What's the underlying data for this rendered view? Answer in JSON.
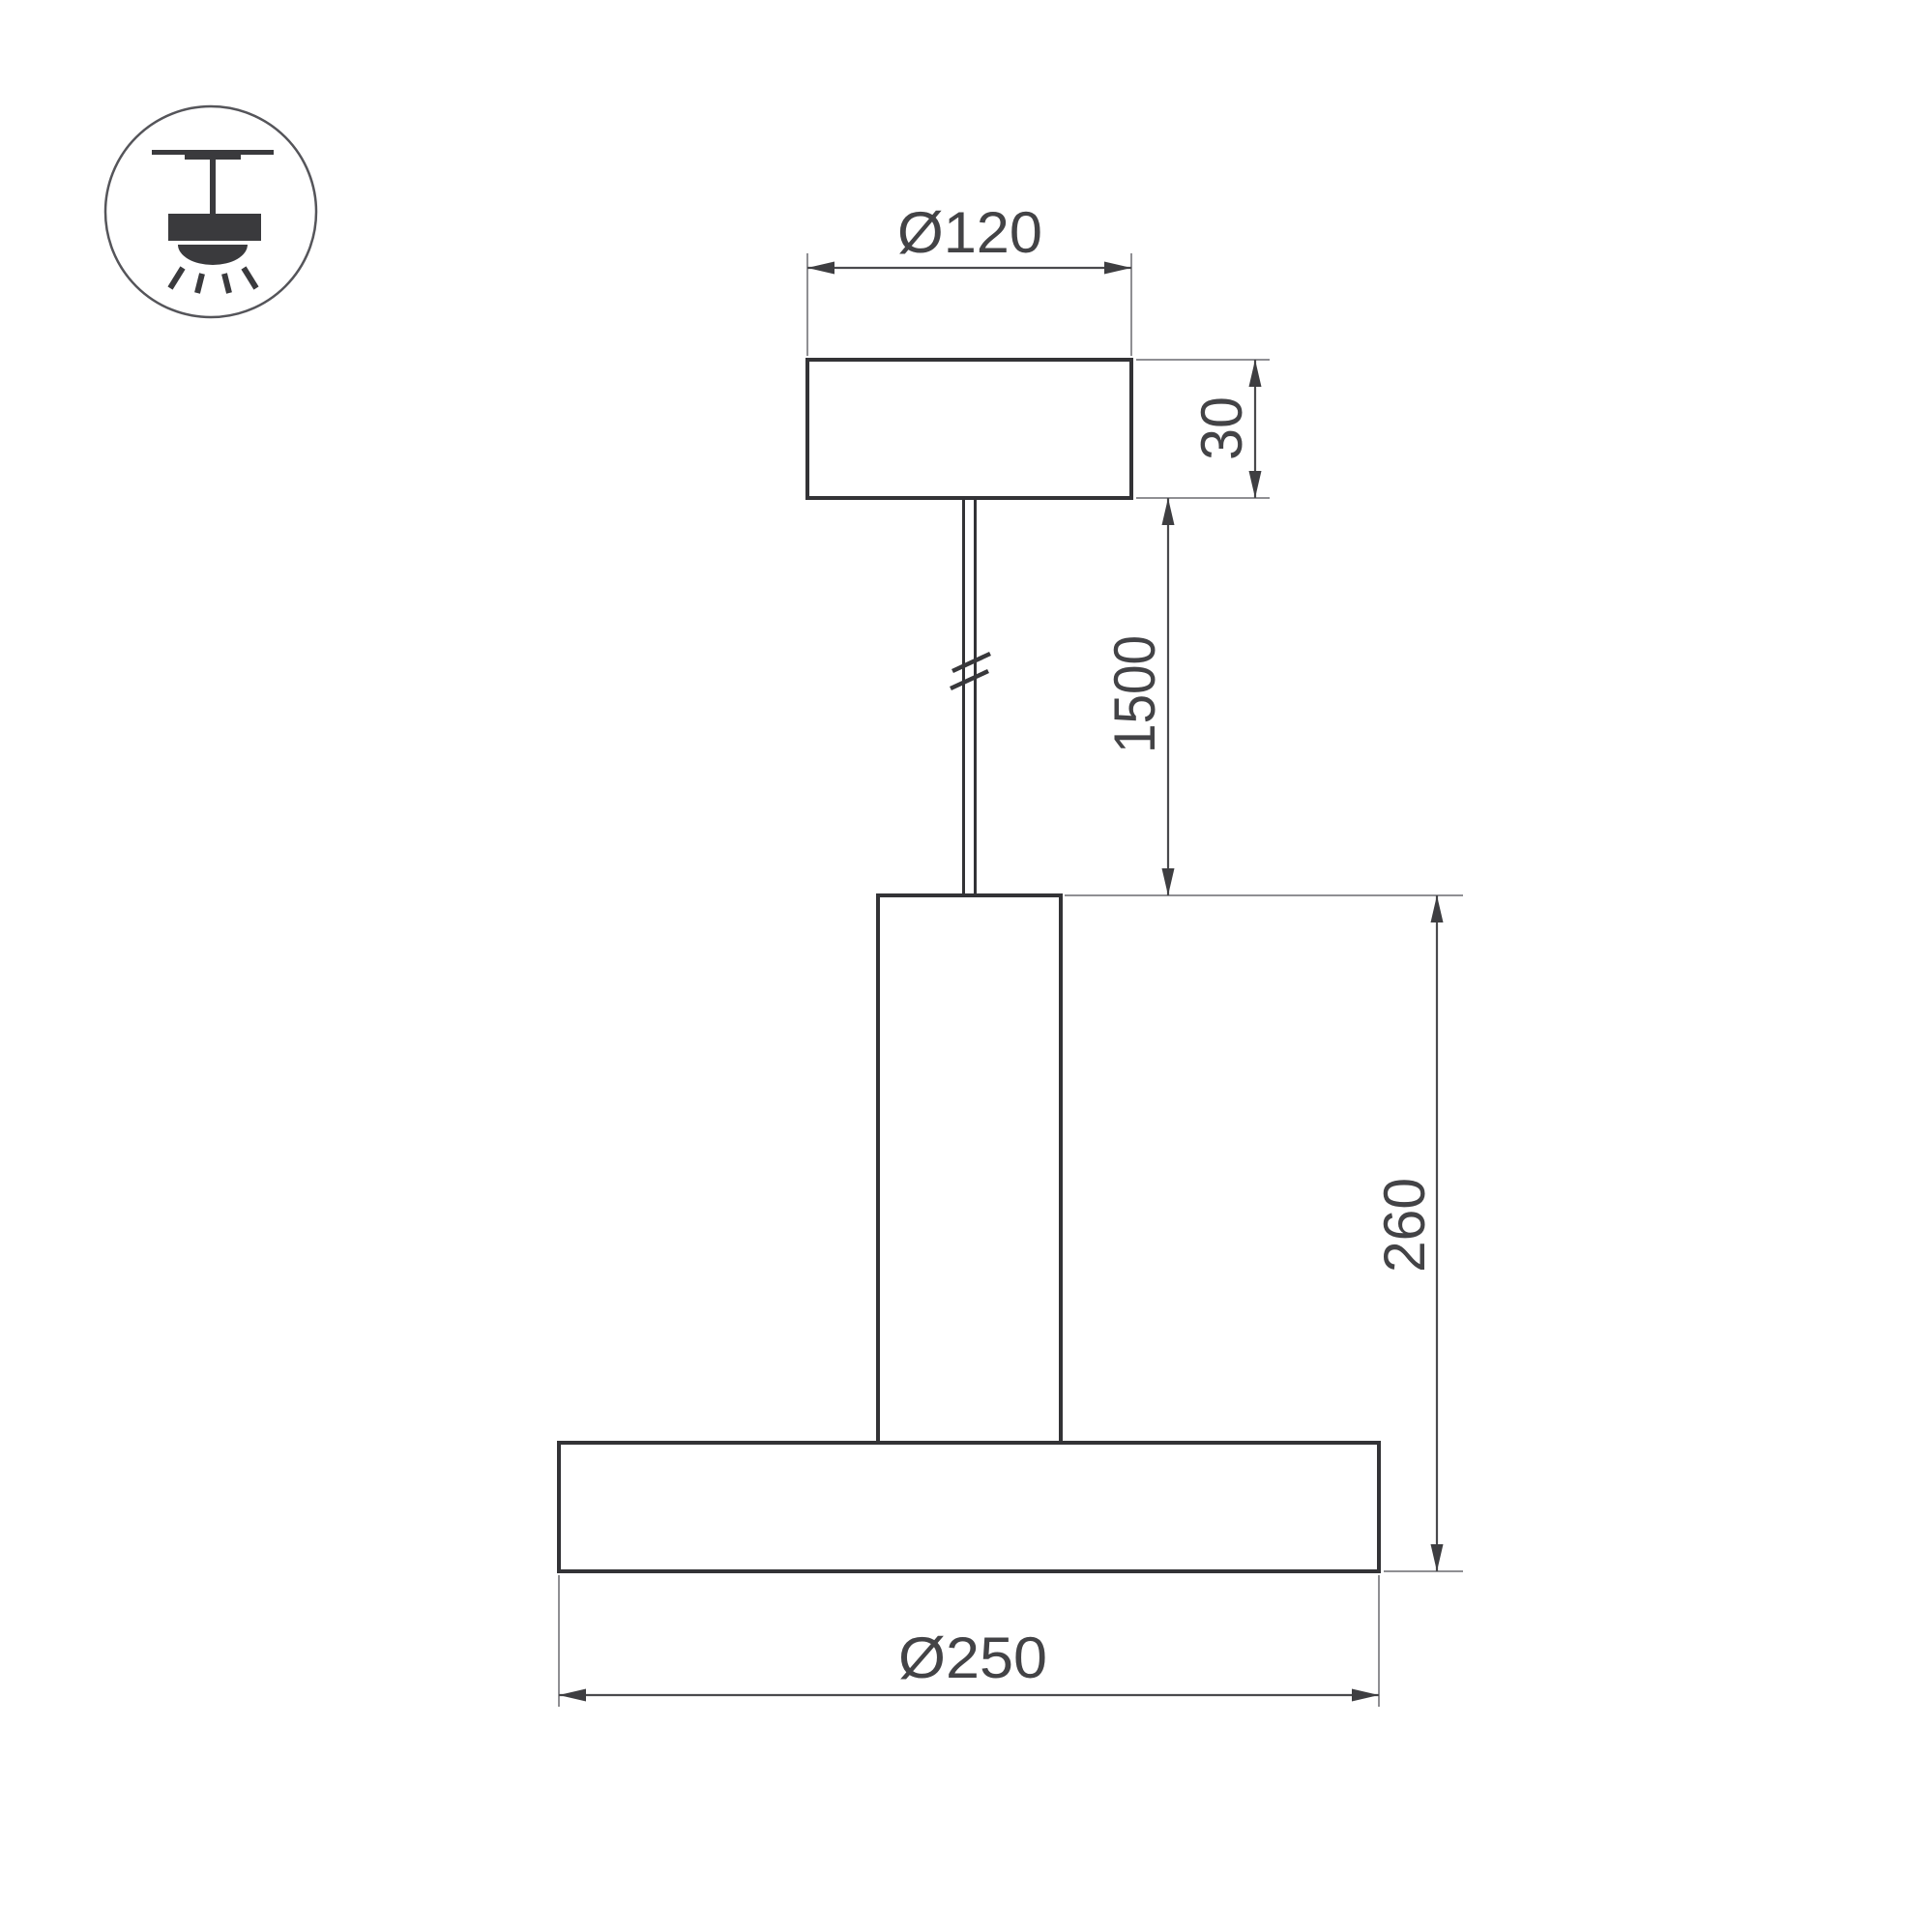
{
  "drawing": {
    "type": "pendant-lamp-technical-drawing",
    "labels": {
      "canopy_diameter": "Ø120",
      "canopy_height": "30",
      "suspension_length": "1500",
      "fixture_height": "260",
      "shade_diameter": "Ø250"
    },
    "icon": "pendant-suspended-light-icon",
    "colors": {
      "background": "#ffffff",
      "outline": "#333336",
      "dimension_line": "#4a4a4d",
      "extension_line": "#8f8f93",
      "arrow": "#3e3e41",
      "text": "#434346",
      "icon": "#3a3a3d"
    }
  }
}
